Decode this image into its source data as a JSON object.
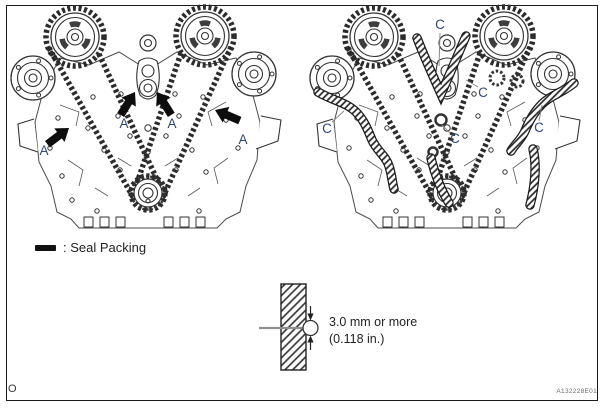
{
  "page": {
    "corner_mark": "O",
    "figure_code": "A132228E01",
    "background": "#ffffff",
    "border_color": "#1b1b1b"
  },
  "colors": {
    "line_art": "#333333",
    "label_text": "#2f4a73",
    "arrow": "#0d0d0d",
    "leader_line": "#8a8a8a",
    "legend_bar": "#111111"
  },
  "left_diagram": {
    "labels": {
      "a1": "A",
      "a2": "A",
      "a3": "A",
      "a4": "A"
    }
  },
  "right_diagram": {
    "labels": {
      "c1": "C",
      "c2": "C",
      "c3": "C",
      "c4": "C",
      "c5": "C"
    }
  },
  "legend": {
    "label": ": Seal Packing"
  },
  "detail_callout": {
    "line1": "3.0 mm or more",
    "line2": "(0.118 in.)"
  }
}
